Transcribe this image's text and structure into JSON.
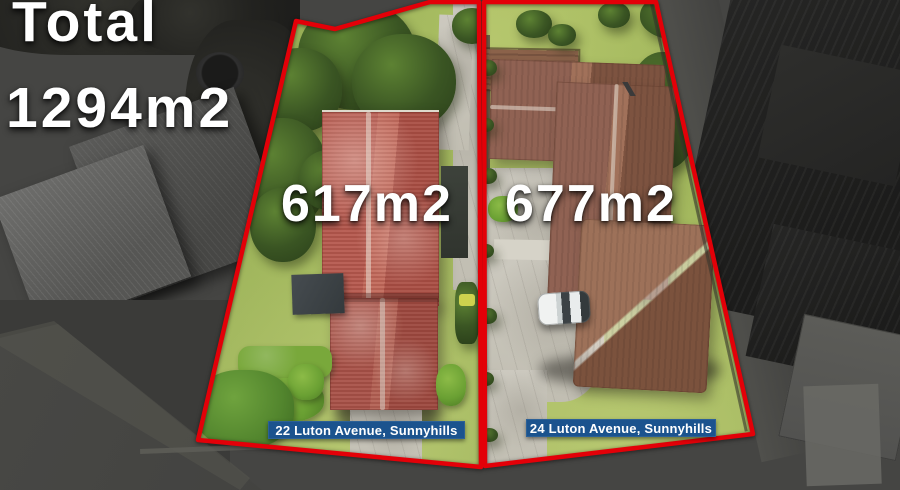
{
  "overlay": {
    "total_label": "Total",
    "total_value": "1294m2"
  },
  "lots": [
    {
      "area_label": "617m2",
      "address_banner": "22 Luton Avenue, Sunnyhills"
    },
    {
      "area_label": "677m2",
      "address_banner": "24 Luton Avenue, Sunnyhills"
    }
  ],
  "colors": {
    "boundary_red": "#e30008",
    "banner_blue": "#1b538e",
    "label_text": "#ffffff"
  }
}
